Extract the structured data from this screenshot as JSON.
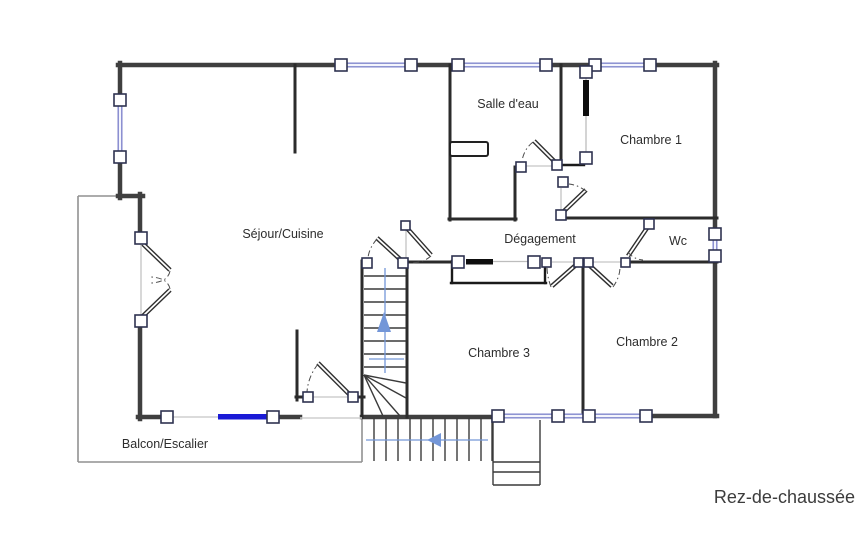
{
  "title": "Rez-de-chaussée",
  "rooms": [
    {
      "id": "sejour-cuisine",
      "label": "Séjour/Cuisine"
    },
    {
      "id": "salle-deau",
      "label": "Salle d'eau"
    },
    {
      "id": "chambre-1",
      "label": "Chambre 1"
    },
    {
      "id": "degagement",
      "label": "Dégagement"
    },
    {
      "id": "wc",
      "label": "Wc"
    },
    {
      "id": "chambre-3",
      "label": "Chambre 3"
    },
    {
      "id": "chambre-2",
      "label": "Chambre 2"
    },
    {
      "id": "balcon-escalier",
      "label": "Balcon/Escalier"
    }
  ],
  "icons": {
    "stairs_up_arrow": "direction of interior stairs (up)",
    "stairs_left_arrow": "direction of exterior stairs (down/left)"
  },
  "colors": {
    "wall_dark": "#3f3f3f",
    "wall_interior": "#2b2b2b",
    "window_blue": "#8086cc",
    "door_blue": "#1a1ad6",
    "arrow_blue": "#7396d8",
    "balcony_gray": "#919191",
    "label_text": "#2d2d2d"
  }
}
